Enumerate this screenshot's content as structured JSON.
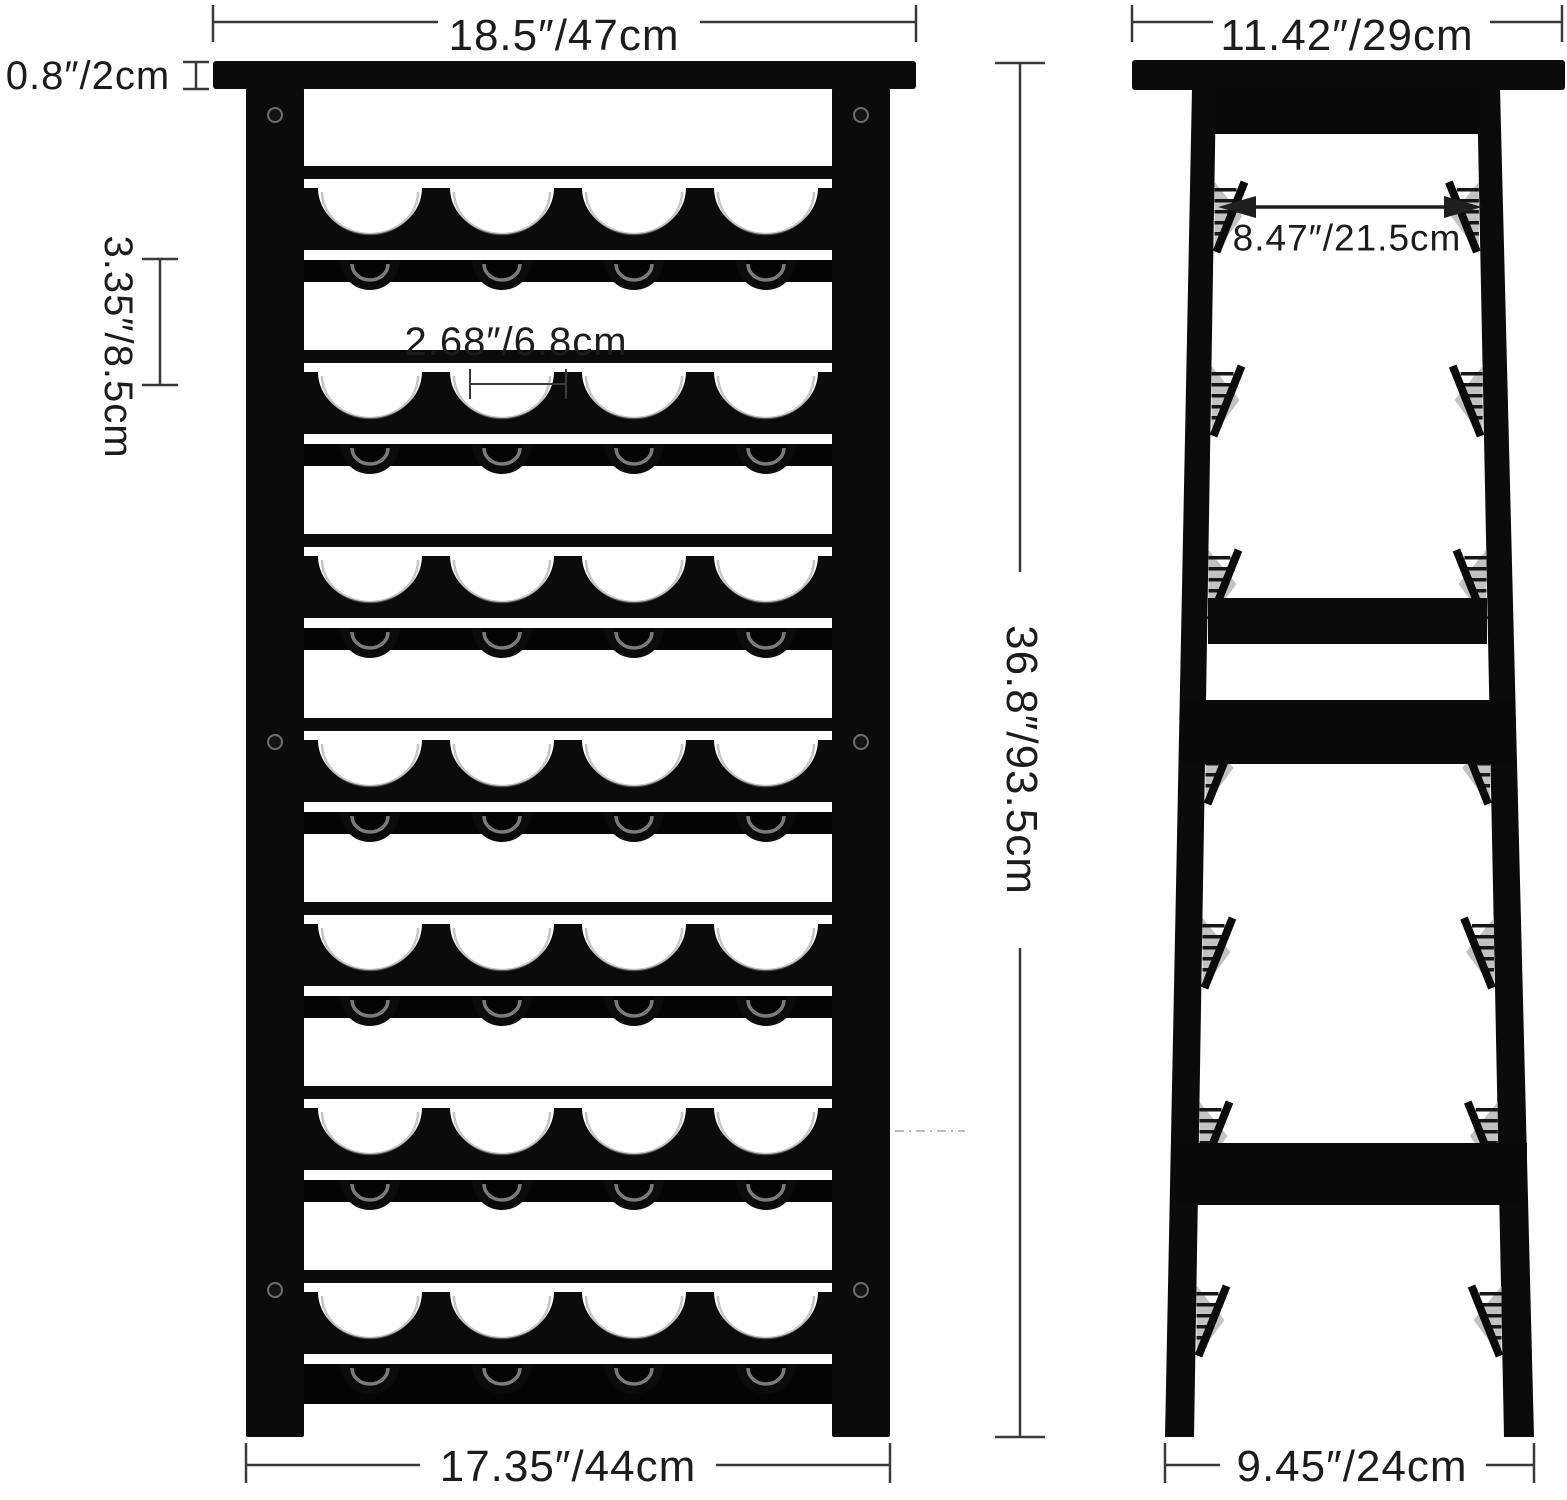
{
  "diagram": {
    "subject": "wine-rack-dimension-diagram",
    "views": {
      "front": "front-view",
      "side": "side-view"
    }
  },
  "rack": {
    "rows": 7,
    "slots_per_row": 4
  },
  "colors": {
    "background": "#ffffff",
    "rack_black": "#0b0b0b",
    "rack_deep": "#050505",
    "highlight_gray": "#989898",
    "comb_gray": "#c2c2c2",
    "dimension_line": "#3a3a3a",
    "text": "#1c1c1c",
    "artifact": "#bcbcbc"
  },
  "dimensions": {
    "top_width": "18.5″/47cm",
    "top_thickness": "0.8″/2cm",
    "row_spacing": "3.35″/8.5cm",
    "slot_width": "2.68″/6.8cm",
    "height": "36.8″/93.5cm",
    "bottom_width": "17.35″/44cm",
    "side_top_depth": "11.42″/29cm",
    "side_inner_depth": "8.47″/21.5cm",
    "side_bottom_depth": "9.45″/24cm"
  }
}
